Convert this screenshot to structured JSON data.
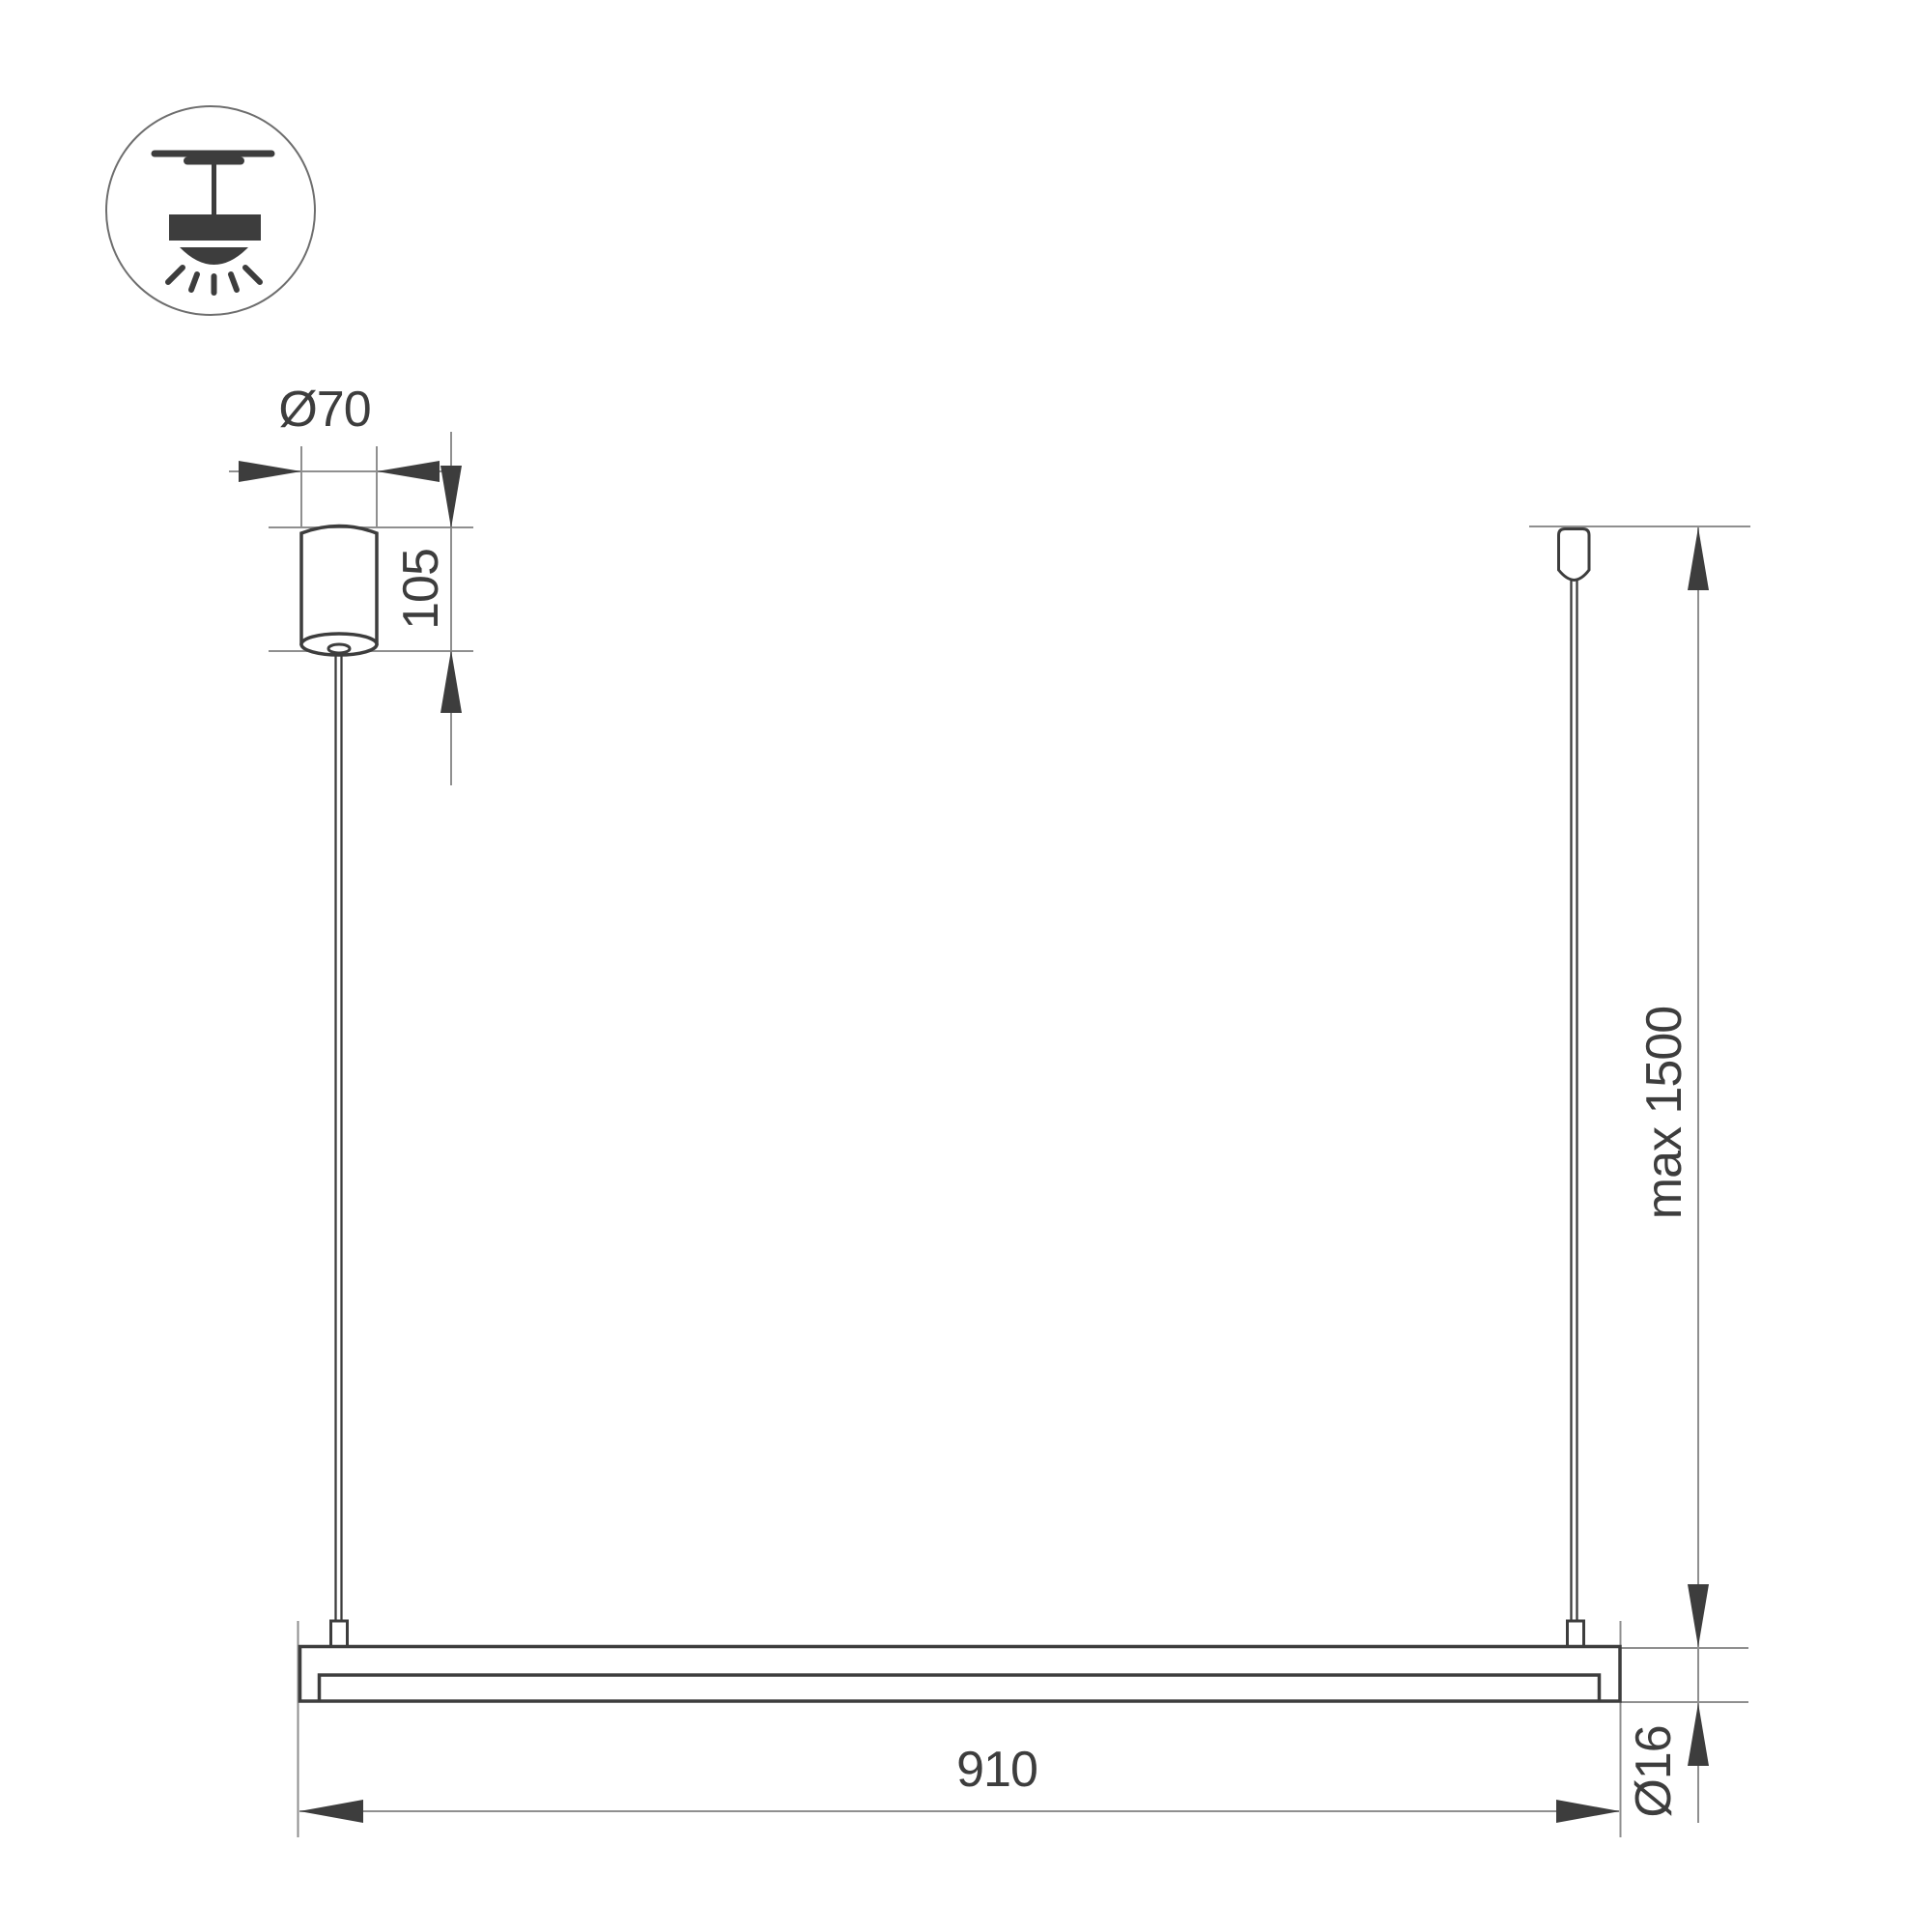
{
  "drawing": {
    "subject": "linear pendant luminaire installation dimensions",
    "icon": {
      "name": "ceiling-pendant-light-icon"
    },
    "labels": {
      "canopy_diameter": "Ø70",
      "canopy_height": "105",
      "suspension_length": "max 1500",
      "fixture_length": "910",
      "tube_diameter": "Ø16"
    },
    "colors": {
      "outline": "#3d3d3d",
      "dimension_line": "#8f8f8f",
      "background": "#ffffff"
    }
  }
}
